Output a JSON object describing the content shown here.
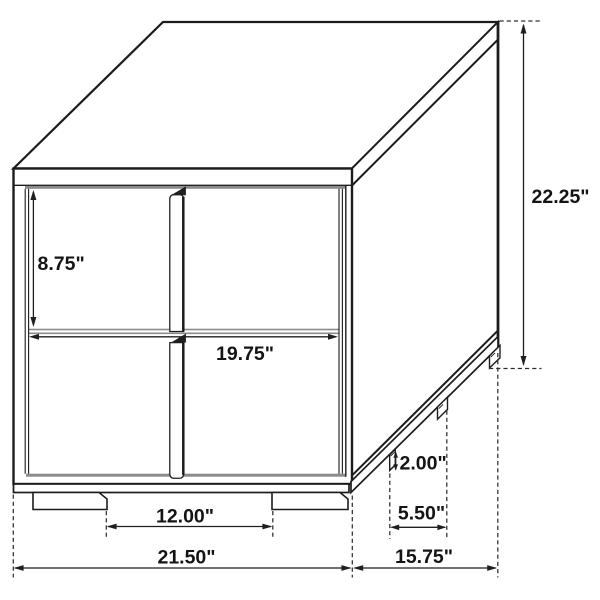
{
  "figure": {
    "type": "isometric dimension drawing",
    "subject": "two-drawer nightstand with full-height center edge pulls and plinth base with feet",
    "unit": "inches",
    "colors": {
      "line": "#1c1c1c",
      "panel_gap_gray": "#8b8b8b",
      "background": "#ffffff",
      "text": "#141414"
    },
    "dims": {
      "upper_drawer_height": {
        "value": 8.75,
        "label": "8.75\""
      },
      "drawer_width": {
        "value": 19.75,
        "label": "19.75\""
      },
      "overall_height": {
        "value": 22.25,
        "label": "22.25\""
      },
      "foot_height": {
        "value": 2.0,
        "label": "2.00\""
      },
      "side_foot_spacing": {
        "value": 5.5,
        "label": "5.50\""
      },
      "overall_depth": {
        "value": 15.75,
        "label": "15.75\""
      },
      "front_foot_spacing": {
        "value": 12.0,
        "label": "12.00\""
      },
      "overall_width": {
        "value": 21.5,
        "label": "21.50\""
      }
    }
  }
}
